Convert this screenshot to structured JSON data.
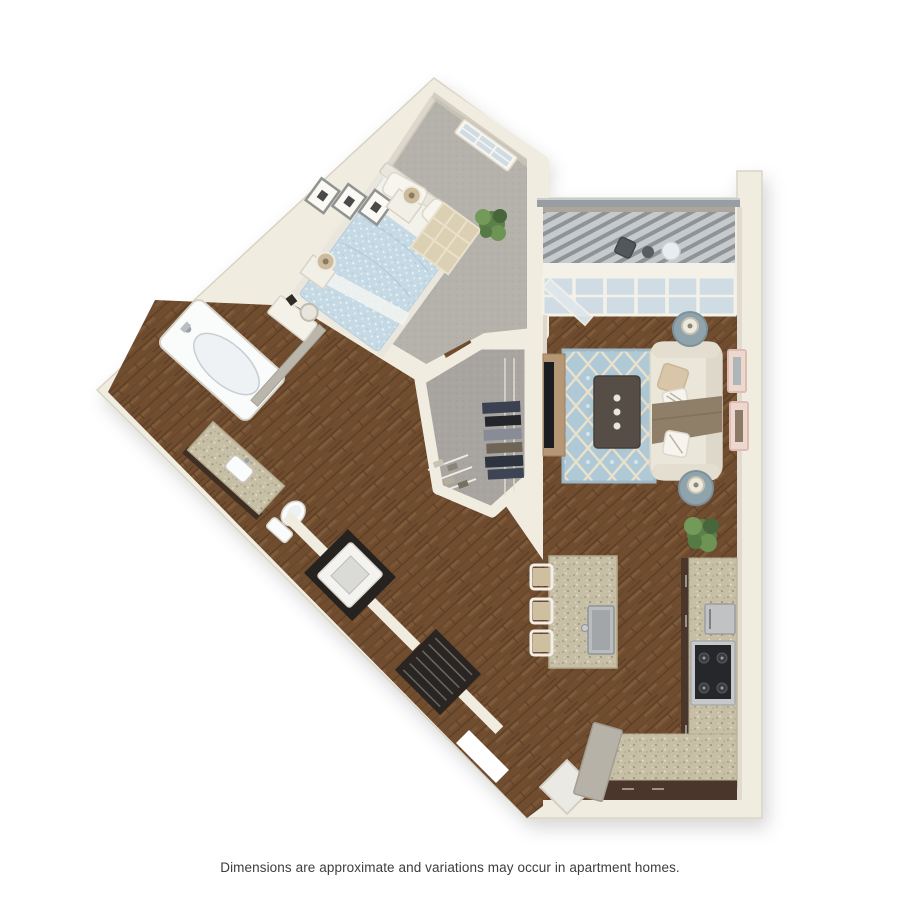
{
  "caption": {
    "text": "Dimensions are approximate and variations may occur in apartment homes."
  },
  "palette": {
    "bg": "#ffffff",
    "caption": "#3d3d3d",
    "wall": "#f1ece0",
    "wall_edge": "#d9d3c4",
    "wall_face": "#e0dbce",
    "wall_face_dark": "#aba69b",
    "carpet": "#b5b2ac",
    "carpet_dark": "#a8a5a0",
    "wood": "#714d30",
    "wood_dark": "#5c3f26",
    "wood_light": "#8a6742",
    "granite": "#c7bea6",
    "cabinet": "#4a362a",
    "rug": "#afc9d7",
    "rug_line": "#e9e1cb",
    "duvet": "#c6dae5",
    "sofa": "#eae6da",
    "glass": "#cfdce4",
    "deck": "#c6cacd",
    "slat": "#8d9397",
    "railing": "#999ea3",
    "steel": "#b9bdbf",
    "fixture": "#fafbfb",
    "plant": "#5d7f49"
  },
  "floorplan": {
    "type": "3d-top-down-floor-plan",
    "unit": "one-bedroom-one-bath-apartment",
    "rooms": [
      "bedroom",
      "bathroom",
      "laundry",
      "walk-in-closet",
      "hallway",
      "living-room",
      "kitchen",
      "balcony",
      "entry"
    ],
    "furniture": [
      "bed",
      "nightstand",
      "table-lamp",
      "wall-frames",
      "bedroom-window",
      "dressing-table",
      "bedroom-rug",
      "plant",
      "bathtub",
      "vanity-sink",
      "toilet",
      "bathroom-door",
      "washer",
      "louvered-closet",
      "closet-clothes",
      "sofa",
      "throw-pillows",
      "throw-blanket",
      "coffee-table",
      "tv-console",
      "side-table",
      "trellis-rug",
      "art-frames",
      "kitchen-island",
      "island-sink",
      "bar-stool",
      "range",
      "microwave",
      "counter-cabinets",
      "entry-door",
      "entry-mat",
      "balcony-chair",
      "balcony-table",
      "patio-door"
    ]
  }
}
